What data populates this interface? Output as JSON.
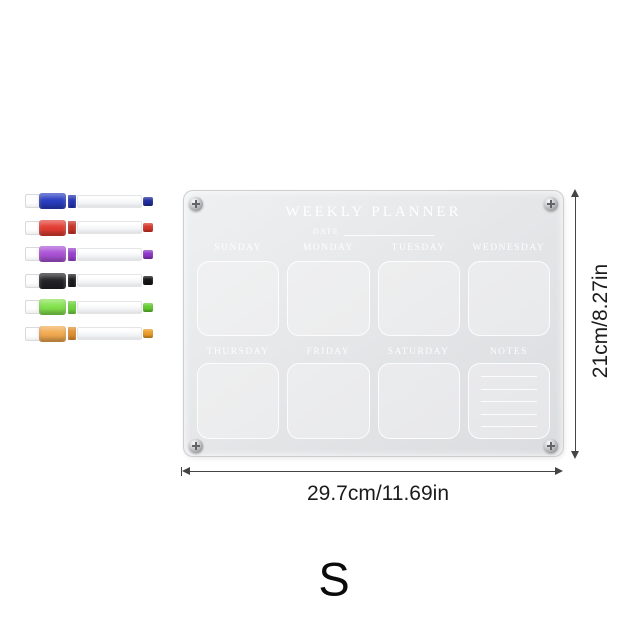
{
  "product": {
    "size_letter": "S"
  },
  "planner": {
    "title": "WEEKLY PLANNER",
    "date_label": "DATE",
    "day_labels": [
      "SUNDAY",
      "MONDAY",
      "TUESDAY",
      "WEDNESDAY",
      "THURSDAY",
      "FRIDAY",
      "SATURDAY"
    ],
    "notes_label": "NOTES",
    "notes_line_count": 5
  },
  "dimensions": {
    "height_label": "21cm/8.27in",
    "width_label": "29.7cm/11.69in"
  },
  "markers": [
    {
      "name": "blue",
      "cap": "#2a3ec2",
      "ring": "#2433b4",
      "tip": "#202e9e"
    },
    {
      "name": "red",
      "cap": "#e23c31",
      "ring": "#c93227",
      "tip": "#d8362b"
    },
    {
      "name": "purple",
      "cap": "#ab52d6",
      "ring": "#9a3fd0",
      "tip": "#8e35c8"
    },
    {
      "name": "black",
      "cap": "#232326",
      "ring": "#1b1b1e",
      "tip": "#141416"
    },
    {
      "name": "green",
      "cap": "#84e24e",
      "ring": "#6fd63c",
      "tip": "#63cc30"
    },
    {
      "name": "orange",
      "cap": "#f2aa50",
      "ring": "#e2912f",
      "tip": "#ec9d28"
    }
  ],
  "colors": {
    "board_light": "#eef0f1",
    "board_dark": "#dbdcdf",
    "dimension_line": "#454545",
    "dimension_text": "#1c1c1c",
    "board_text": "#ffffff"
  }
}
